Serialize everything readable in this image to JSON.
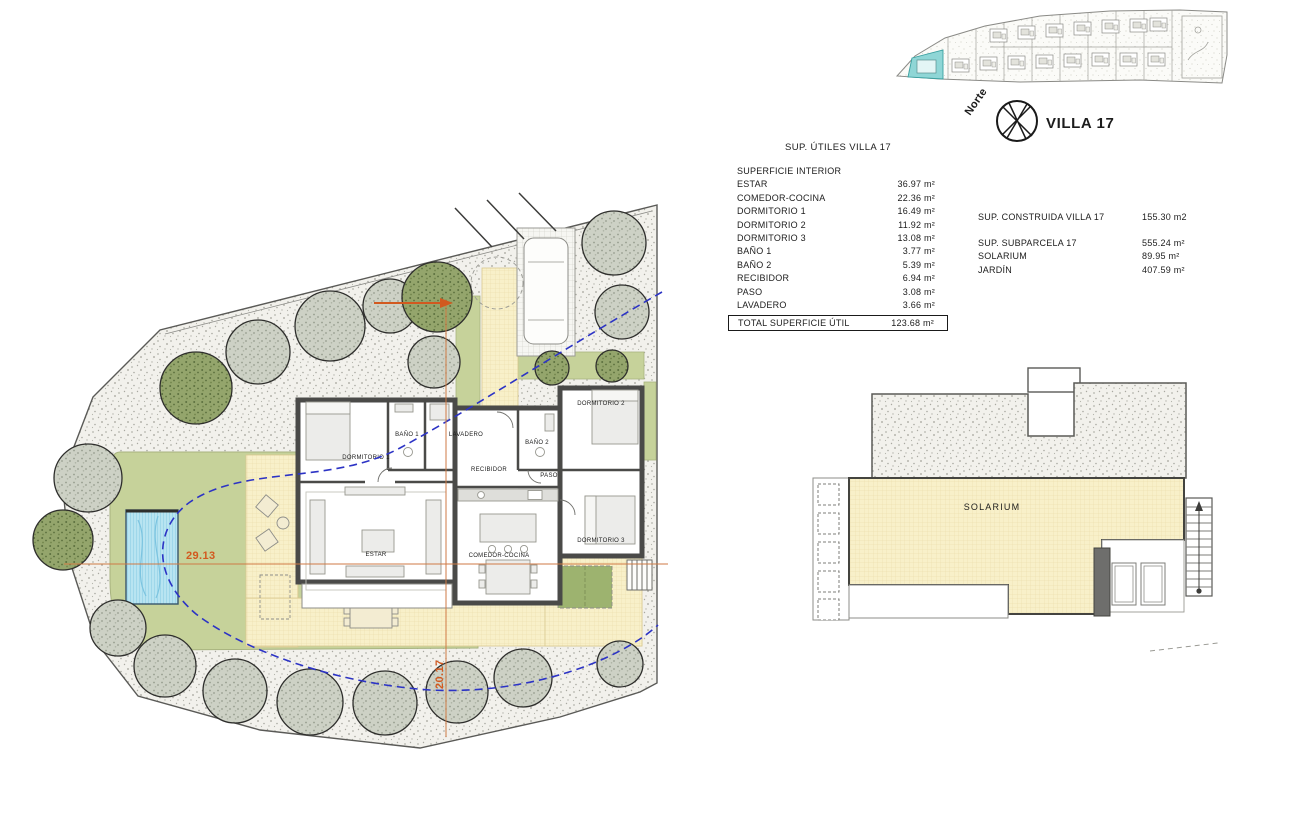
{
  "header": {
    "villa_title": "VILLA 17",
    "north_label": "Norte"
  },
  "area_table": {
    "title": "SUP. ÚTILES VILLA 17",
    "section": "SUPERFICIE INTERIOR",
    "rows": [
      {
        "label": "ESTAR",
        "value": "36.97 m²"
      },
      {
        "label": "COMEDOR-COCINA",
        "value": "22.36 m²"
      },
      {
        "label": "DORMITORIO 1",
        "value": "16.49 m²"
      },
      {
        "label": "DORMITORIO 2",
        "value": "11.92 m²"
      },
      {
        "label": "DORMITORIO 3",
        "value": "13.08 m²"
      },
      {
        "label": "BAÑO 1",
        "value": "3.77 m²"
      },
      {
        "label": "BAÑO 2",
        "value": "5.39 m²"
      },
      {
        "label": "RECIBIDOR",
        "value": "6.94 m²"
      },
      {
        "label": "PASO",
        "value": "3.08 m²"
      },
      {
        "label": "LAVADERO",
        "value": "3.66 m²"
      }
    ],
    "total": {
      "label": "TOTAL SUPERFICIE ÚTIL",
      "value": "123.68 m²"
    }
  },
  "summary_table": {
    "built": {
      "label": "SUP. CONSTRUIDA VILLA 17",
      "value": "155.30 m2"
    },
    "rows": [
      {
        "label": "SUP. SUBPARCELA 17",
        "value": "555.24 m²"
      },
      {
        "label": "SOLARIUM",
        "value": "89.95 m²"
      },
      {
        "label": "JARDÍN",
        "value": "407.59 m²"
      }
    ]
  },
  "floor_plan": {
    "rooms": {
      "dormitorio1": "DORMITORIO 1",
      "dormitorio2": "DORMITORIO 2",
      "dormitorio3": "DORMITORIO 3",
      "bano1": "BAÑO 1",
      "bano2": "BAÑO 2",
      "lavadero": "LAVADERO",
      "recibidor": "RECIBIDOR",
      "paso": "PASO",
      "estar": "ESTAR",
      "comedor": "COMEDOR-COCINA"
    },
    "dimensions": {
      "horizontal": "29.13",
      "vertical": "20.17"
    }
  },
  "roof_plan": {
    "label": "SOLARIUM"
  },
  "colors": {
    "lawn": "#c6d29a",
    "pool": "#b8e4f1",
    "terrace": "#f8f0ca",
    "wall": "#4a4a48",
    "dimension": "#d2591f",
    "setback_line": "#2c33c5",
    "highlight_plot": "#8fd6d6"
  }
}
